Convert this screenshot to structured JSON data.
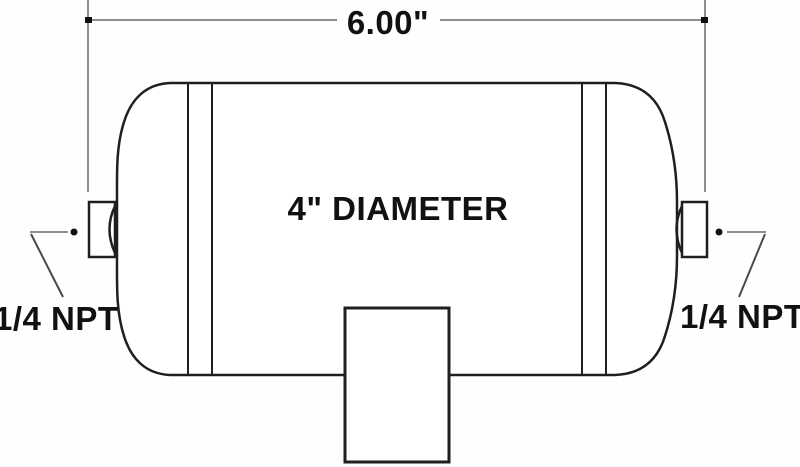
{
  "diagram": {
    "type": "technical-drawing",
    "subject": "air tank side view",
    "length_dimension_label": "6.00\"",
    "diameter_label": "4\" DIAMETER",
    "left_port_label": "1/4 NPT",
    "right_port_label": "1/4 NPT"
  },
  "colors": {
    "background": "#ffffff",
    "outline": "#1f1f1f",
    "dimension_line": "#8f8f8f",
    "leader_line": "#4a4a4a",
    "text": "#111111"
  }
}
